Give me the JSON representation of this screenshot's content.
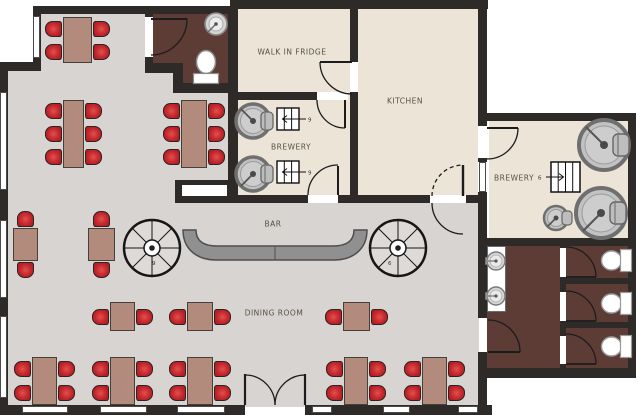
{
  "plan_title": "Restaurant brewery floor plan",
  "colors": {
    "wall": "#2d2a28",
    "floor_dining": "#d8d4d2",
    "floor_kitchen": "#ece5d7",
    "floor_restroom": "#5d3c35",
    "chair_red": "#c4262b",
    "table_brown": "#b28b7c",
    "bar_counter": "#8f8f8f"
  },
  "rooms": [
    {
      "id": "walk-in-fridge",
      "label": "WALK IN FRIDGE"
    },
    {
      "id": "kitchen",
      "label": "KITCHEN"
    },
    {
      "id": "brewery-middle",
      "label": "BREWERY"
    },
    {
      "id": "brewery-right",
      "label": "BREWERY"
    },
    {
      "id": "bar",
      "label": "BAR"
    },
    {
      "id": "dining-room",
      "label": "DINING ROOM"
    }
  ],
  "stairs": {
    "middle_upper_label": "9",
    "middle_lower_label": "9",
    "right_label": "6",
    "spiral_left_label": "9",
    "spiral_right_label": "6"
  },
  "fixtures": {
    "brew_tanks": 5,
    "toilets": 4,
    "sinks": 3,
    "spiral_staircases": 2
  },
  "furniture": {
    "chair_count": 46,
    "tables": [
      {
        "x": 63,
        "y": 17,
        "w": 29,
        "h": 46,
        "sides": "lr",
        "n": 2
      },
      {
        "x": 63,
        "y": 100,
        "w": 21,
        "h": 68,
        "sides": "lr",
        "n": 3
      },
      {
        "x": 181,
        "y": 100,
        "w": 26,
        "h": 68,
        "sides": "lr",
        "n": 3
      },
      {
        "x": 13,
        "y": 228,
        "w": 25,
        "h": 33,
        "sides": "tb",
        "n": 1
      },
      {
        "x": 88,
        "y": 228,
        "w": 27,
        "h": 33,
        "sides": "tb",
        "n": 1
      },
      {
        "x": 110,
        "y": 302,
        "w": 25,
        "h": 29,
        "sides": "lr",
        "n": 1
      },
      {
        "x": 187,
        "y": 302,
        "w": 26,
        "h": 29,
        "sides": "lr",
        "n": 1
      },
      {
        "x": 343,
        "y": 302,
        "w": 27,
        "h": 29,
        "sides": "lr",
        "n": 1
      },
      {
        "x": 32,
        "y": 357,
        "w": 25,
        "h": 48,
        "sides": "lr",
        "n": 2
      },
      {
        "x": 110,
        "y": 357,
        "w": 25,
        "h": 48,
        "sides": "lr",
        "n": 2
      },
      {
        "x": 187,
        "y": 357,
        "w": 26,
        "h": 48,
        "sides": "lr",
        "n": 2
      },
      {
        "x": 344,
        "y": 357,
        "w": 24,
        "h": 48,
        "sides": "lr",
        "n": 2
      },
      {
        "x": 422,
        "y": 357,
        "w": 25,
        "h": 48,
        "sides": "lr",
        "n": 2
      }
    ]
  }
}
